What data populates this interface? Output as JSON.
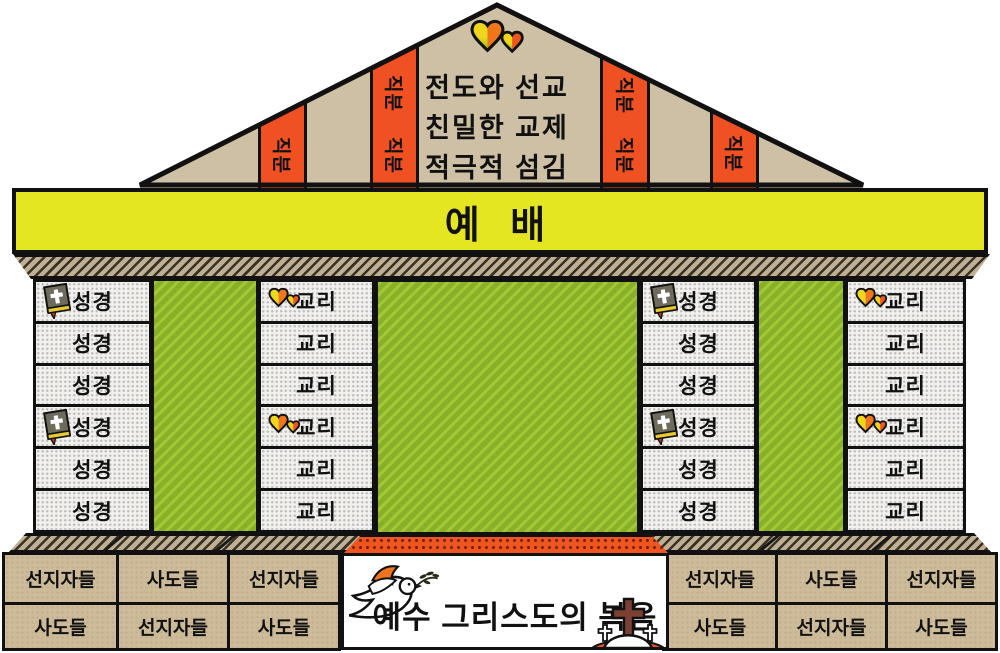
{
  "pediment": {
    "heart_icon": "double-hearts-icon",
    "text_lines": [
      "전도와 선교",
      "친밀한 교제",
      "적극적 섬김"
    ],
    "bars": [
      {
        "labels": [
          "직분"
        ]
      },
      {
        "labels": [
          "직분",
          "직분"
        ]
      },
      {
        "labels": [
          "직분",
          "직분"
        ]
      },
      {
        "labels": [
          "직분"
        ]
      }
    ]
  },
  "beam": {
    "label": "예 배"
  },
  "colonnade": {
    "columns": [
      {
        "name": "bible-column-left",
        "icon": "bible-icon",
        "icon_rows": [
          0,
          3
        ],
        "blocks": [
          "성경",
          "성경",
          "성경",
          "성경",
          "성경",
          "성경"
        ]
      },
      {
        "name": "doctrine-column-left",
        "icon": "hearts-icon",
        "icon_rows": [
          0,
          3
        ],
        "blocks": [
          "교리",
          "교리",
          "교리",
          "교리",
          "교리",
          "교리"
        ]
      },
      {
        "name": "bible-column-right",
        "icon": "bible-icon",
        "icon_rows": [
          0,
          3
        ],
        "blocks": [
          "성경",
          "성경",
          "성경",
          "성경",
          "성경",
          "성경"
        ]
      },
      {
        "name": "doctrine-column-right",
        "icon": "hearts-icon",
        "icon_rows": [
          0,
          3
        ],
        "blocks": [
          "교리",
          "교리",
          "교리",
          "교리",
          "교리",
          "교리"
        ]
      }
    ]
  },
  "foundation": {
    "left_rows": [
      [
        "선지자들",
        "사도들",
        "선지자들"
      ],
      [
        "사도들",
        "선지자들",
        "사도들"
      ]
    ],
    "right_rows": [
      [
        "선지자들",
        "사도들",
        "선지자들"
      ],
      [
        "사도들",
        "선지자들",
        "사도들"
      ]
    ]
  },
  "banner": {
    "label": "예수 그리스도의 복음",
    "icons": [
      "dove-icon",
      "three-crosses-icon"
    ]
  },
  "colors": {
    "yellow_beam": "#e4e622",
    "orange": "#f05123",
    "green": "#88b02a",
    "pediment_tan": "#cdc0a5",
    "stone_tan": "#cdbb99",
    "hatch_tan": "#bfb093"
  }
}
